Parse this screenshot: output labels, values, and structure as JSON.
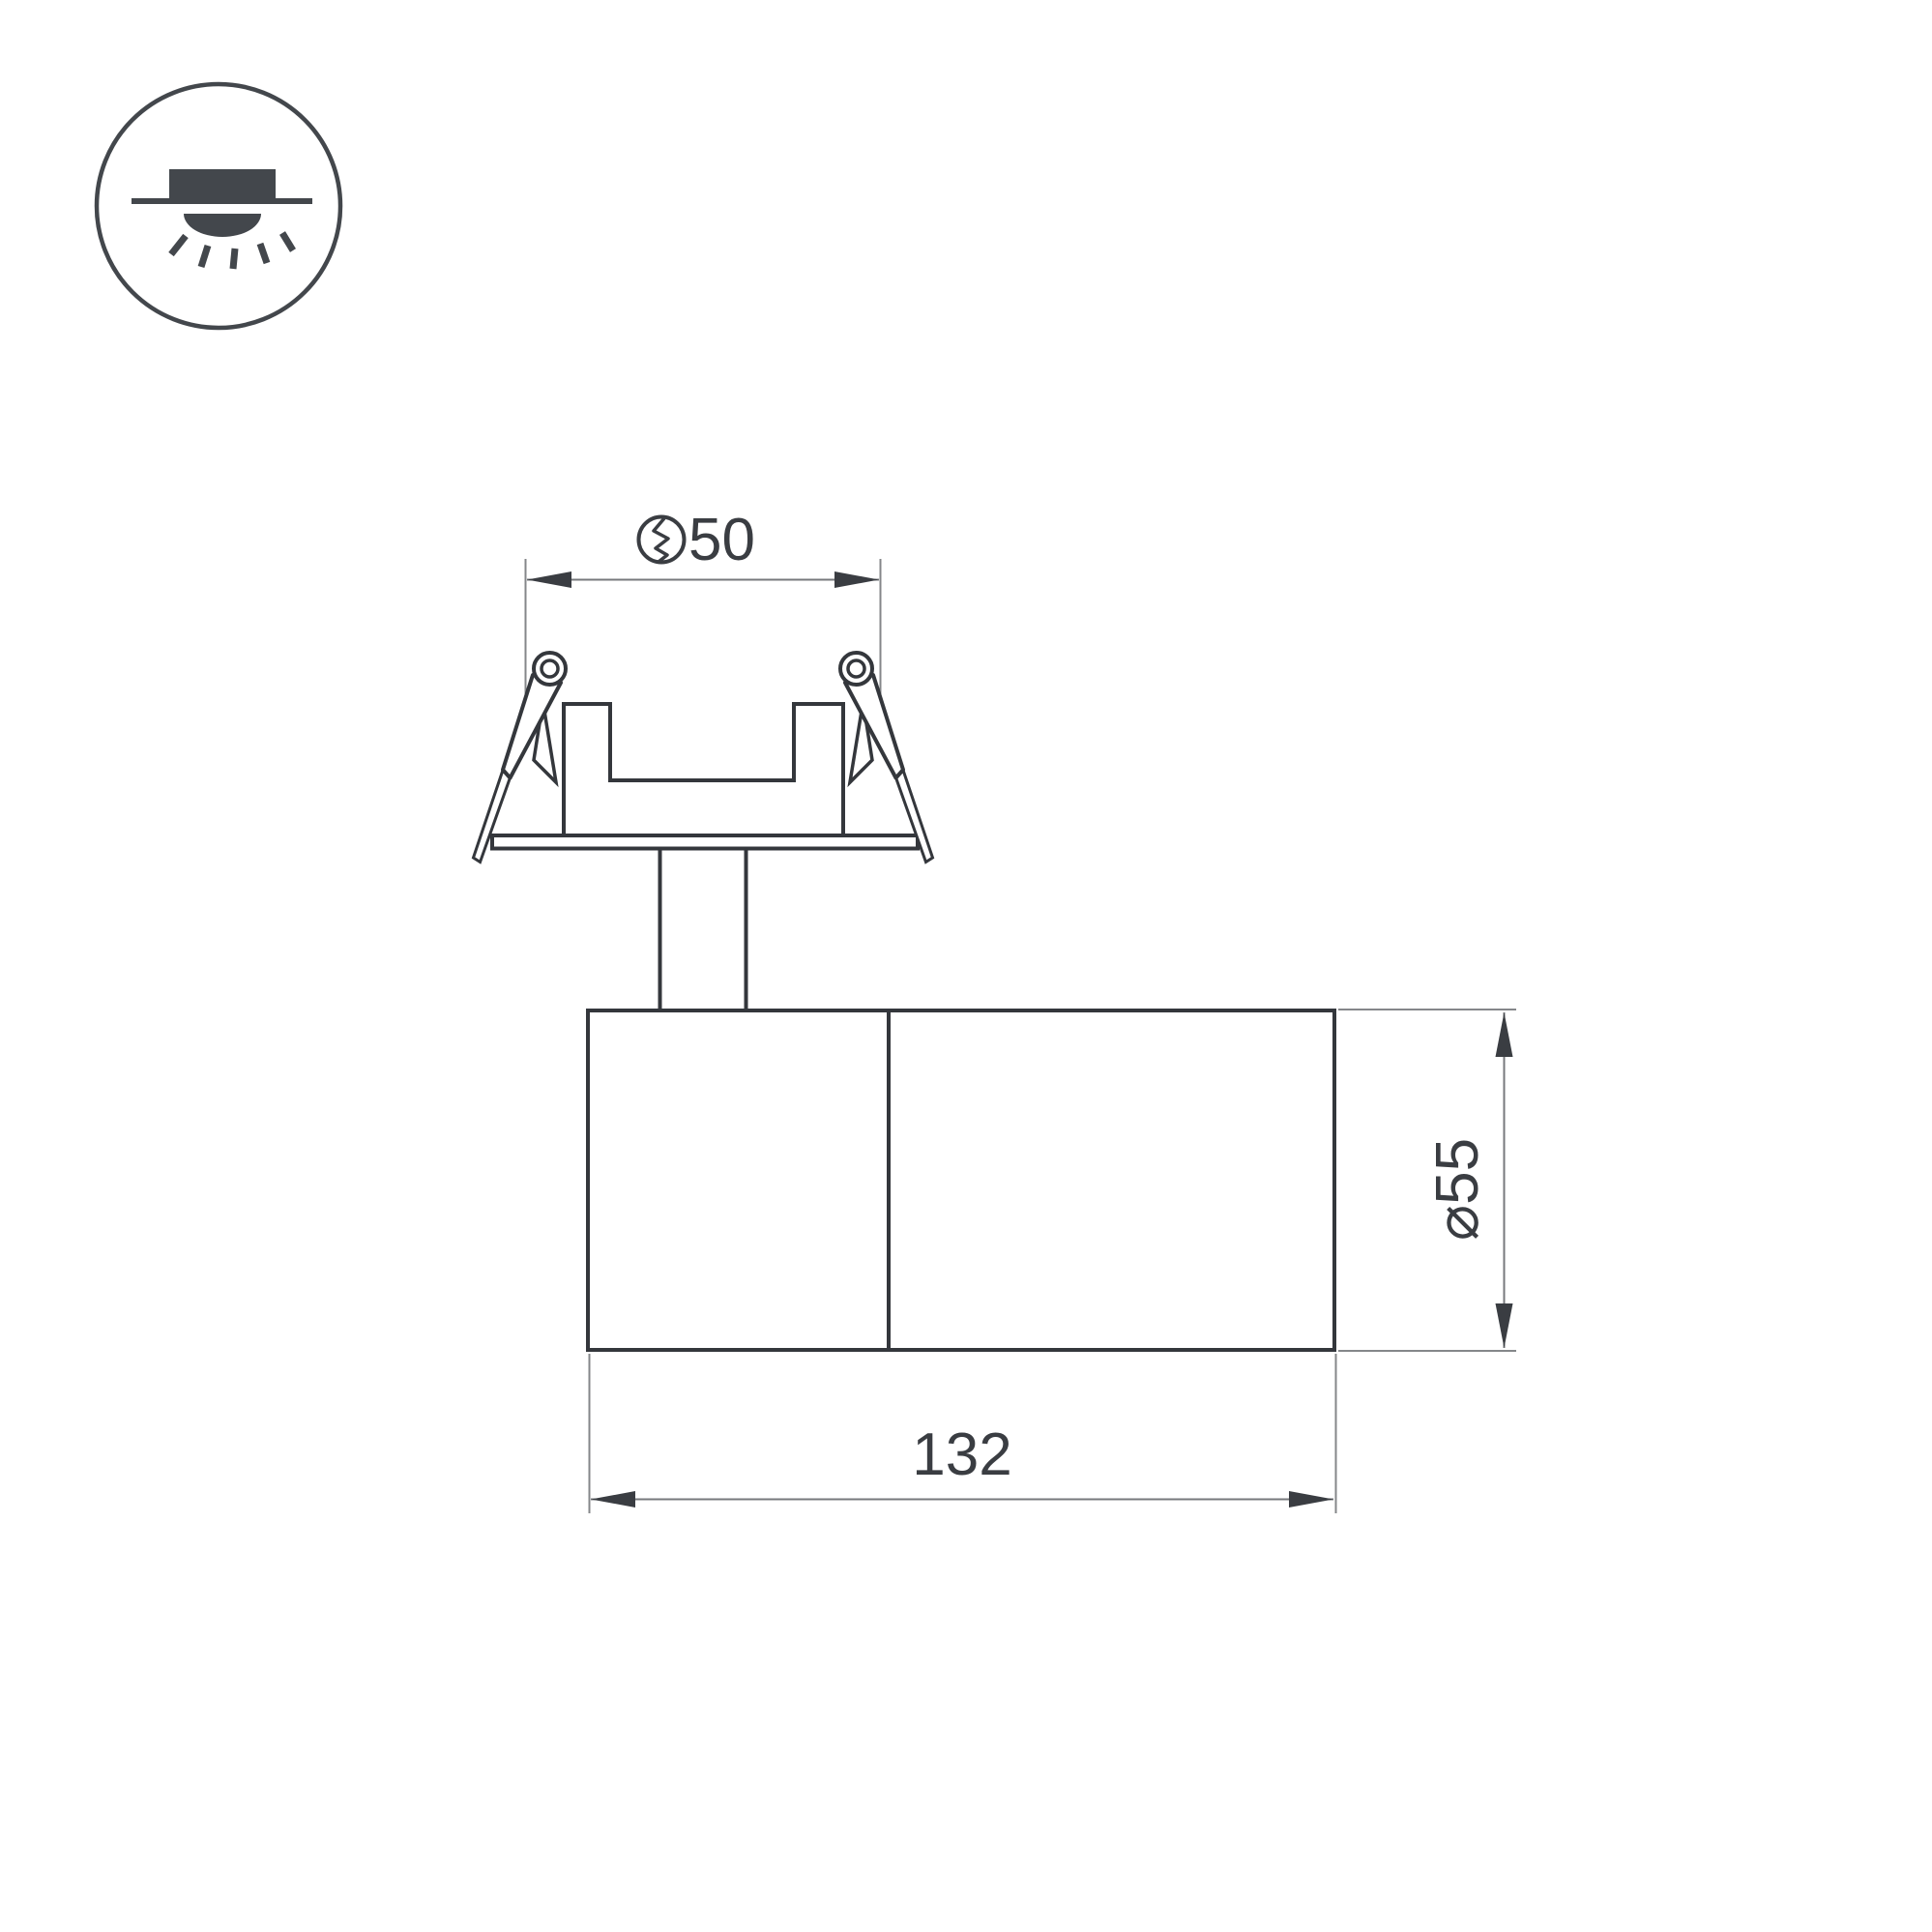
{
  "page": {
    "background_color": "#ffffff",
    "type": "technical-dimension-drawing",
    "subject": "recessed-mounted adjustable spot luminaire, side view"
  },
  "colors": {
    "outline": "#34373c",
    "thin_line": "#85878a",
    "dim_line": "#77797c",
    "ink": "#3a3d42",
    "icon_fill": "#43474c"
  },
  "badge": {
    "icon": "recessed-downlight"
  },
  "dimensions": {
    "cutout": {
      "label": "50",
      "icon": "hole-cutout-diameter"
    },
    "diameter": {
      "label": "⌀55"
    },
    "length": {
      "label": "132"
    }
  }
}
